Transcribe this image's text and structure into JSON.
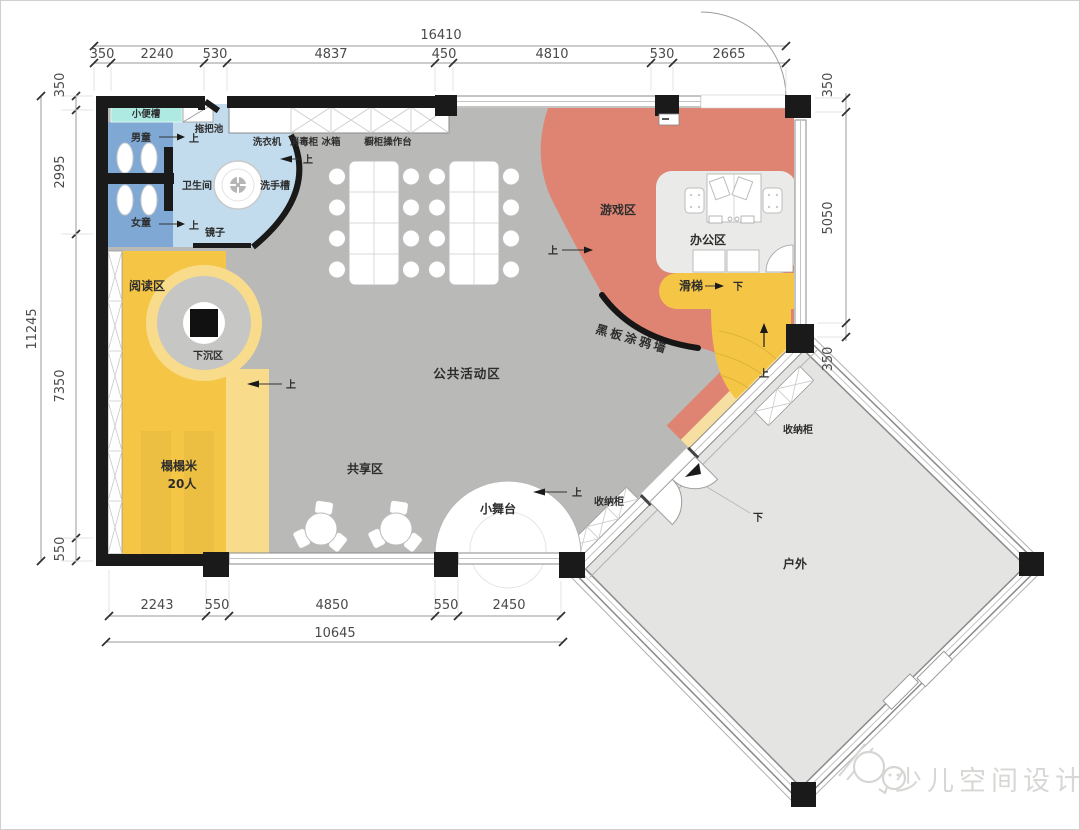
{
  "dimensions": {
    "top": {
      "total": "16410",
      "segments": [
        "350",
        "2240",
        "530",
        "4837",
        "450",
        "4810",
        "530",
        "2665"
      ]
    },
    "left": {
      "total": "11245",
      "segments": [
        "350",
        "2995",
        "7350",
        "550"
      ]
    },
    "right": {
      "segments": [
        "350",
        "5050",
        "350"
      ]
    },
    "bottom": {
      "total": "10645",
      "segments": [
        "2243",
        "550",
        "4850",
        "550",
        "2450"
      ]
    }
  },
  "rooms": {
    "urinal": "小便槽",
    "mop_pool": "拖把池",
    "washing_machine": "洗衣机",
    "sterilizer": "消毒柜",
    "fridge": "冰箱",
    "kitchen_counter": "橱柜操作台",
    "boys": "男童",
    "girls": "女童",
    "toilet": "卫生间",
    "sink": "洗手槽",
    "mirror": "镜子",
    "reading": "阅读区",
    "sunken": "下沉区",
    "tatami_line1": "榻榻米",
    "tatami_line2": "20人",
    "shared": "共享区",
    "public_activity": "公共活动区",
    "stage": "小舞台",
    "game": "游戏区",
    "office": "办公区",
    "slide": "滑梯",
    "blackboard": "黑板涂鸦墙",
    "storage_inner": "收纳柜",
    "storage_outdoor": "收纳柜",
    "outdoor": "户外"
  },
  "annotations": {
    "up": "上",
    "down": "下"
  },
  "watermark": {
    "text": "少儿空间设计"
  },
  "colors": {
    "floor": "#b9b9b7",
    "game": "#df8472",
    "tatami": "#f5c645",
    "tatami_light": "#f8dc8c",
    "band_light": "#f6dfa0",
    "bath_dark": "#7fa9d4",
    "bath_light": "#c2dcee",
    "urinal": "#aeeae2",
    "office": "#eaeae8",
    "outdoor": "#e4e4e2",
    "wall": "#1a1a1a"
  }
}
